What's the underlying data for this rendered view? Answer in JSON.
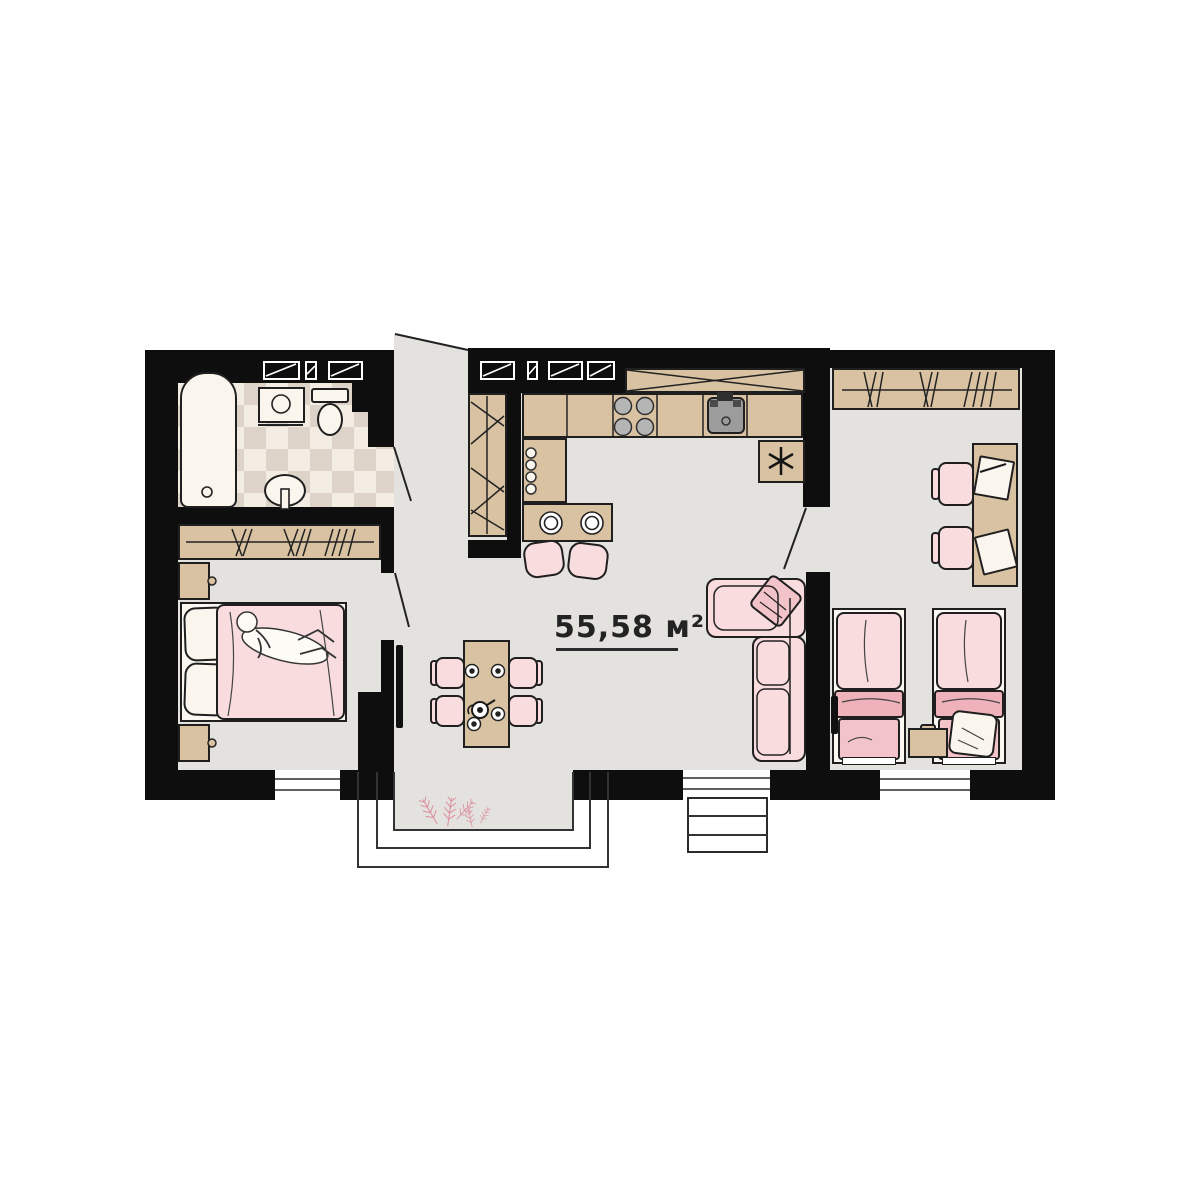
{
  "plan": {
    "area_label": "55,58 м²"
  },
  "colors": {
    "background": "#ffffff",
    "wall": "#0e0e0e",
    "floor": "#e4e2df",
    "tile-light": "#f2ece3",
    "tile-dark": "#ded3c8",
    "wood": "#d9c2a2",
    "line": "#1f1f1f",
    "pink-light": "#f8dcde",
    "pink-mid": "#f2c3c9",
    "pink-dark": "#efb2ba",
    "fixture": "#faf6ee",
    "appliance": "#9c9c9c",
    "plant": "#dc8f9e"
  },
  "rooms": {
    "bathroom": [
      "bathtub-icon",
      "washbasin-icon",
      "toilet-icon",
      "pedestal-sink-icon",
      "tile-floor"
    ],
    "bedroom-left": [
      "wardrobe-icon",
      "double-bed-icon",
      "sleeping-person-icon",
      "nightstand-icon",
      "nightstand-icon",
      "tv-icon"
    ],
    "kitchen": [
      "wall-cabinets-icon",
      "countertop-icon",
      "stove-icon",
      "kitchen-sink-icon",
      "fridge-icon",
      "breakfast-bar-icon",
      "bar-chair-icon",
      "bar-chair-icon",
      "hall-closet-icon"
    ],
    "living-dining": [
      "dining-table-icon",
      "dining-chair-icon",
      "dining-chair-icon",
      "dining-chair-icon",
      "dining-chair-icon",
      "plates-icon",
      "teapot-icon",
      "corner-sofa-icon",
      "pillow-icon",
      "tv-icon"
    ],
    "bedroom-right": [
      "wardrobe-icon",
      "desk-icon",
      "desk-chair-icon",
      "desk-chair-icon",
      "papers-icon",
      "single-bed-icon",
      "single-bed-icon",
      "nightstand-icon",
      "tv-icon"
    ],
    "entrance": [
      "porch-steps-icon",
      "plants-icon",
      "side-steps-icon",
      "terrace-door-icon"
    ]
  }
}
